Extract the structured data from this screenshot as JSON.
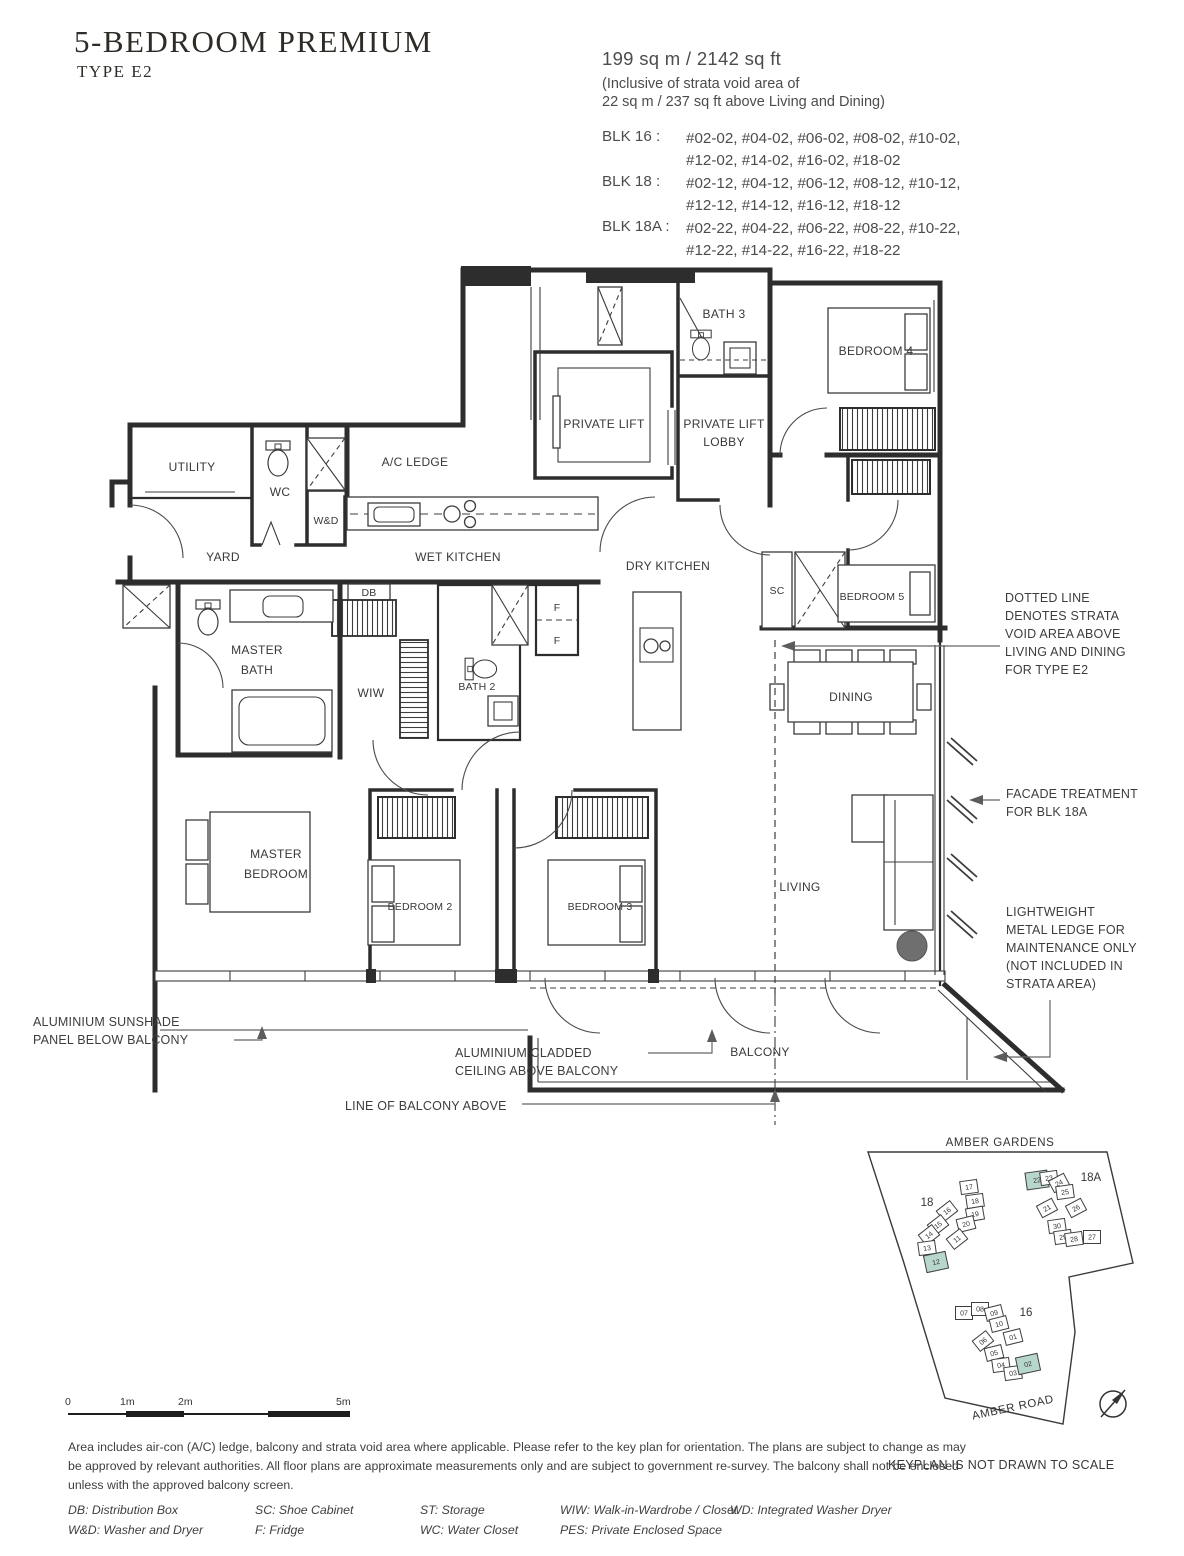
{
  "header": {
    "title": "5-BEDROOM PREMIUM",
    "subtitle": "TYPE E2"
  },
  "info": {
    "area_line1": "199 sq m / 2142 sq ft",
    "area_line2": "(Inclusive of strata void area of",
    "area_line3": "22 sq m / 237 sq ft above Living and Dining)",
    "blocks": [
      {
        "label": "BLK 16 :",
        "units_line1": "#02-02, #04-02, #06-02, #08-02, #10-02,",
        "units_line2": "#12-02, #14-02, #16-02, #18-02"
      },
      {
        "label": "BLK 18 :",
        "units_line1": "#02-12, #04-12, #06-12, #08-12, #10-12,",
        "units_line2": "#12-12, #14-12, #16-12, #18-12"
      },
      {
        "label": "BLK 18A :",
        "units_line1": "#02-22, #04-22, #06-22, #08-22, #10-22,",
        "units_line2": "#12-22, #14-22, #16-22, #18-22"
      }
    ]
  },
  "plan": {
    "labels": {
      "utility": "UTILITY",
      "wc": "WC",
      "wd": "W&D",
      "ac_ledge": "A/C LEDGE",
      "private_lift": "PRIVATE LIFT",
      "lobby_line1": "PRIVATE LIFT",
      "lobby_line2": "LOBBY",
      "bath3": "BATH 3",
      "bedroom4": "BEDROOM 4",
      "yard": "YARD",
      "wet_kitchen": "WET KITCHEN",
      "dry_kitchen": "DRY KITCHEN",
      "sc": "SC",
      "bedroom5": "BEDROOM 5",
      "db": "DB",
      "master_bath_line1": "MASTER",
      "master_bath_line2": "BATH",
      "wiw": "WIW",
      "bath2": "BATH 2",
      "fridge1": "F",
      "fridge2": "F",
      "dining": "DINING",
      "master_bedroom_line1": "MASTER",
      "master_bedroom_line2": "BEDROOM",
      "bedroom2": "BEDROOM 2",
      "bedroom3": "BEDROOM 3",
      "living": "LIVING",
      "balcony": "BALCONY"
    },
    "annotations": {
      "strata_void": [
        "DOTTED LINE",
        "DENOTES STRATA",
        "VOID AREA ABOVE",
        "LIVING AND DINING",
        "FOR TYPE E2"
      ],
      "facade": [
        "FACADE TREATMENT",
        "FOR BLK 18A"
      ],
      "metal_ledge": [
        "LIGHTWEIGHT",
        "METAL LEDGE FOR",
        "MAINTENANCE ONLY",
        "(NOT INCLUDED IN",
        "STRATA AREA)"
      ],
      "sunshade": [
        "ALUMINIUM SUNSHADE",
        "PANEL BELOW BALCONY"
      ],
      "cladded": [
        "ALUMINIUM CLADDED",
        "CEILING ABOVE BALCONY"
      ],
      "balcony_line": "LINE OF BALCONY ABOVE"
    }
  },
  "keyplan": {
    "top_road": "AMBER GARDENS",
    "bottom_road": "AMBER ROAD",
    "note": "KEYPLAN IS NOT DRAWN TO SCALE",
    "highlight_color": "#b7d7cc",
    "blocks": [
      {
        "label": "18",
        "label_x": 927,
        "label_y": 1206,
        "units": [
          {
            "n": "17",
            "x": 969,
            "y": 1187,
            "r": -8,
            "hl": false
          },
          {
            "n": "18",
            "x": 975,
            "y": 1201,
            "r": -8,
            "hl": false
          },
          {
            "n": "19",
            "x": 975,
            "y": 1214,
            "r": -10,
            "hl": false
          },
          {
            "n": "20",
            "x": 966,
            "y": 1224,
            "r": -14,
            "hl": false
          },
          {
            "n": "11",
            "x": 957,
            "y": 1239,
            "r": -38,
            "hl": false
          },
          {
            "n": "16",
            "x": 947,
            "y": 1211,
            "r": -38,
            "hl": false
          },
          {
            "n": "15",
            "x": 938,
            "y": 1225,
            "r": -38,
            "hl": false
          },
          {
            "n": "14",
            "x": 929,
            "y": 1235,
            "r": -38,
            "hl": false
          },
          {
            "n": "13",
            "x": 927,
            "y": 1248,
            "r": -8,
            "hl": false
          },
          {
            "n": "12",
            "x": 936,
            "y": 1262,
            "r": -12,
            "hl": true
          }
        ]
      },
      {
        "label": "18A",
        "label_x": 1091,
        "label_y": 1181,
        "units": [
          {
            "n": "22",
            "x": 1037,
            "y": 1180,
            "r": -8,
            "hl": true
          },
          {
            "n": "23",
            "x": 1049,
            "y": 1178,
            "r": -8,
            "hl": false
          },
          {
            "n": "24",
            "x": 1059,
            "y": 1183,
            "r": -28,
            "hl": false
          },
          {
            "n": "25",
            "x": 1065,
            "y": 1192,
            "r": -8,
            "hl": false
          },
          {
            "n": "26",
            "x": 1076,
            "y": 1208,
            "r": -28,
            "hl": false
          },
          {
            "n": "21",
            "x": 1047,
            "y": 1208,
            "r": -28,
            "hl": false
          },
          {
            "n": "30",
            "x": 1057,
            "y": 1226,
            "r": -8,
            "hl": false
          },
          {
            "n": "29",
            "x": 1063,
            "y": 1237,
            "r": -8,
            "hl": false
          },
          {
            "n": "28",
            "x": 1074,
            "y": 1239,
            "r": -8,
            "hl": false
          },
          {
            "n": "27",
            "x": 1092,
            "y": 1237,
            "r": 0,
            "hl": false
          }
        ]
      },
      {
        "label": "16",
        "label_x": 1026,
        "label_y": 1316,
        "units": [
          {
            "n": "07",
            "x": 964,
            "y": 1313,
            "r": 0,
            "hl": false
          },
          {
            "n": "08",
            "x": 980,
            "y": 1309,
            "r": 0,
            "hl": false
          },
          {
            "n": "09",
            "x": 994,
            "y": 1313,
            "r": -14,
            "hl": false
          },
          {
            "n": "10",
            "x": 999,
            "y": 1324,
            "r": -14,
            "hl": false
          },
          {
            "n": "01",
            "x": 1013,
            "y": 1337,
            "r": -14,
            "hl": false
          },
          {
            "n": "06",
            "x": 983,
            "y": 1341,
            "r": -38,
            "hl": false
          },
          {
            "n": "05",
            "x": 994,
            "y": 1353,
            "r": -14,
            "hl": false
          },
          {
            "n": "04",
            "x": 1001,
            "y": 1365,
            "r": -8,
            "hl": false
          },
          {
            "n": "03",
            "x": 1013,
            "y": 1373,
            "r": -8,
            "hl": false
          },
          {
            "n": "02",
            "x": 1028,
            "y": 1364,
            "r": -12,
            "hl": true
          }
        ]
      }
    ]
  },
  "scalebar": {
    "labels": [
      "0",
      "1m",
      "2m",
      "5m"
    ]
  },
  "footer": {
    "disclaimer": [
      "Area includes air-con (A/C) ledge, balcony and strata void area where applicable. Please refer to the key plan for orientation. The plans are subject to change as may",
      "be approved by relevant authorities. All floor plans are approximate measurements only and are subject to government re-survey. The balcony shall not be enclosed",
      "unless with the approved balcony screen."
    ],
    "legend_rows": [
      [
        "DB: Distribution Box",
        "SC: Shoe Cabinet",
        "ST: Storage",
        "WIW: Walk-in-Wardrobe / Closet",
        "WD: Integrated Washer Dryer"
      ],
      [
        "W&D: Washer and Dryer",
        "F: Fridge",
        "WC: Water Closet",
        "PES: Private Enclosed Space"
      ]
    ]
  }
}
